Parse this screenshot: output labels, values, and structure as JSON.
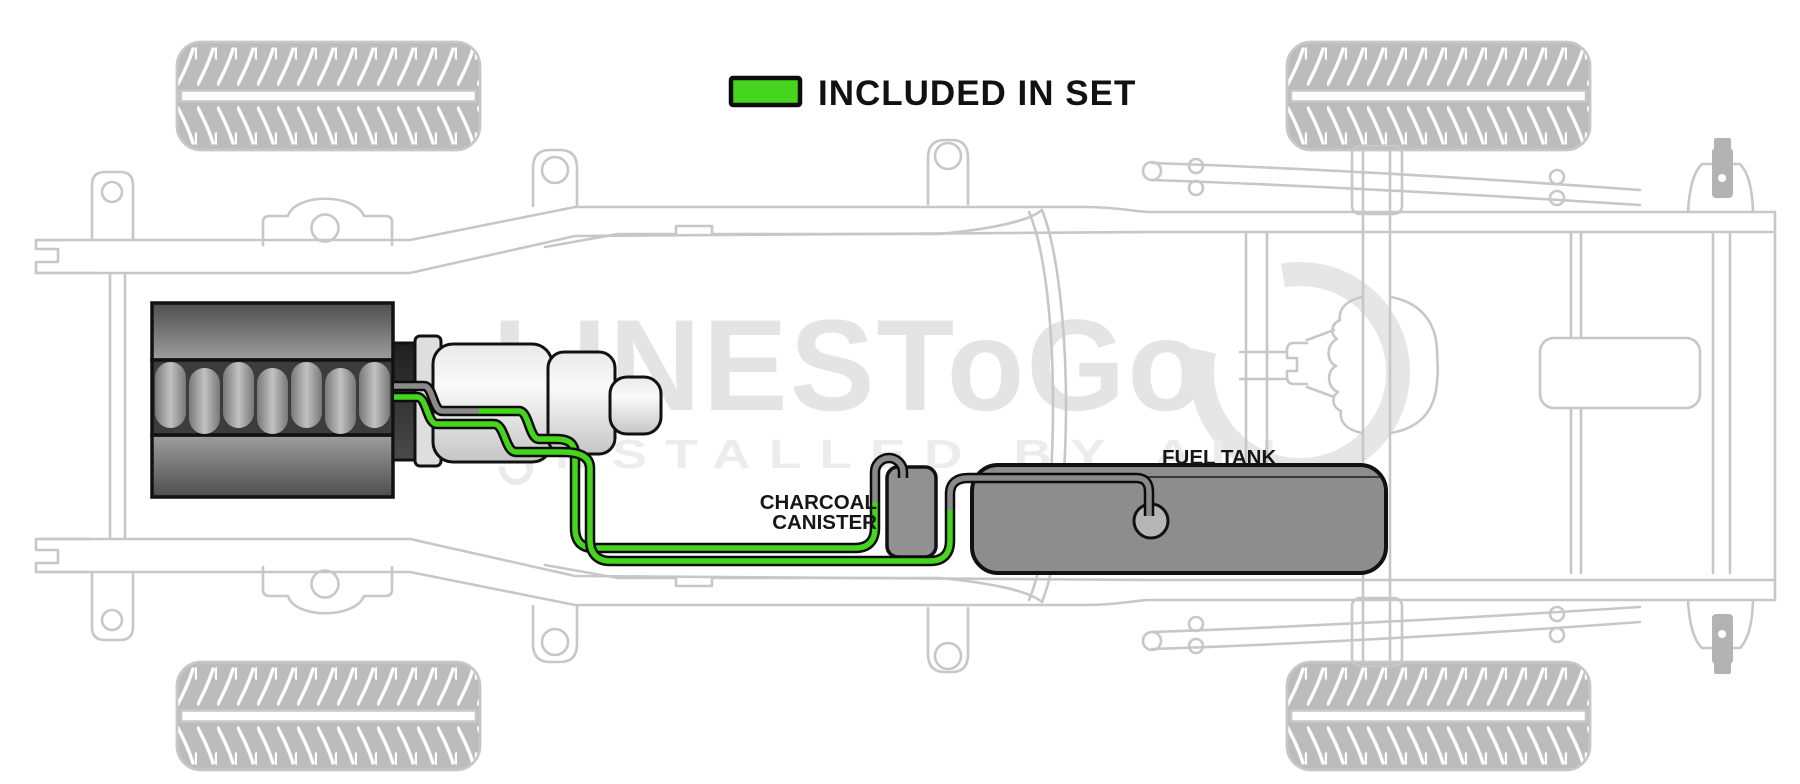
{
  "legend": {
    "label": "INCLUDED IN SET"
  },
  "callouts": {
    "charcoal_canister": {
      "line1": "CHARCOAL",
      "line2": "CANISTER"
    },
    "fuel_tank": "FUEL TANK"
  },
  "watermark": {
    "brand": "LINESToGo",
    "tagline": "INSTALLED BY ALL"
  },
  "colors": {
    "included_line": "#45d51c",
    "excluded_line": "#8a8a8a",
    "chassis_outline": "#c7c7c7",
    "tank_fill": "#8d8d8d",
    "canister_fill": "#919191",
    "label_text": "#161616",
    "watermark_gray": "#e4e4e4"
  }
}
